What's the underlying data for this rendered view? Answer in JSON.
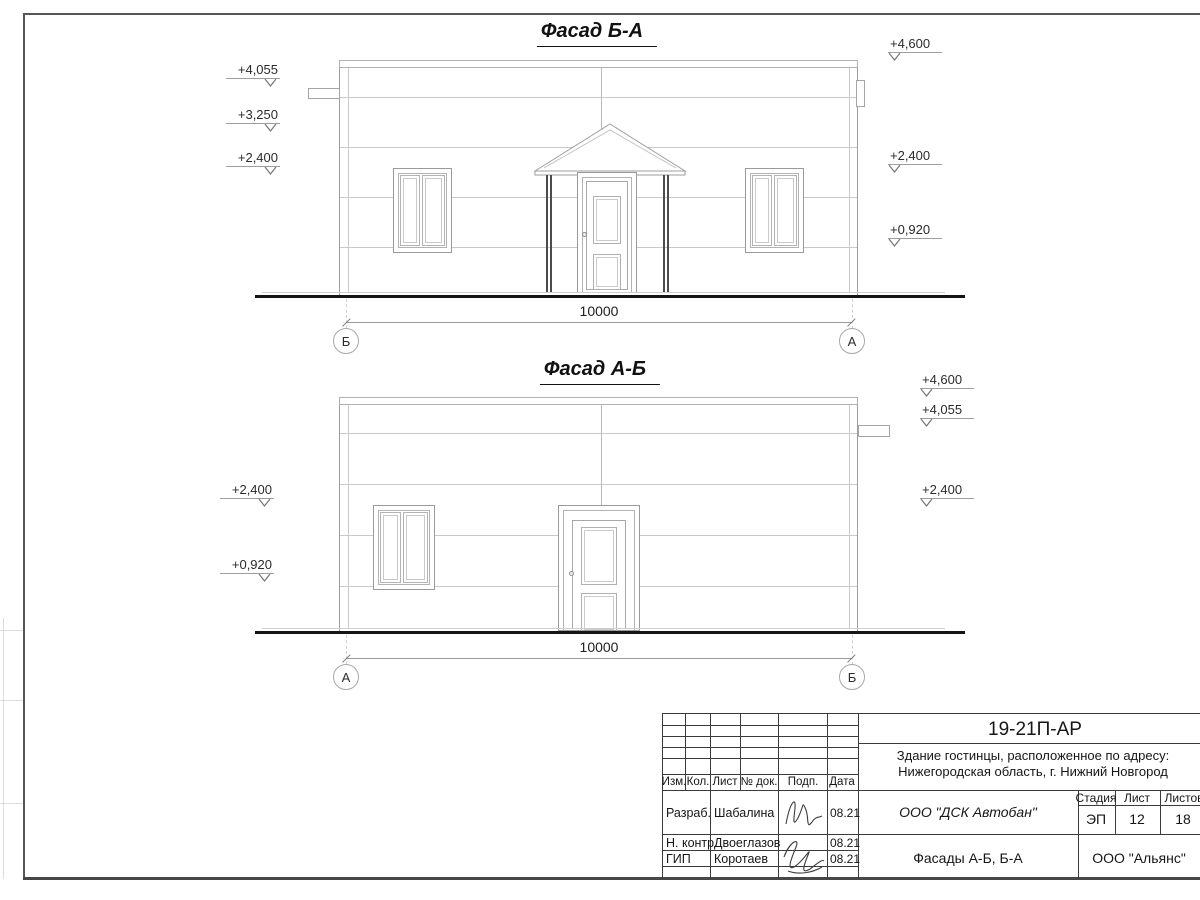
{
  "sheet": {
    "facades": [
      {
        "title": "Фасад Б-А",
        "dimension": "10000",
        "axis_left": "Б",
        "axis_right": "А",
        "levels_left": [
          "+4,055",
          "+3,250",
          "+2,400"
        ],
        "levels_right": [
          "+4,600",
          "+2,400",
          "+0,920"
        ]
      },
      {
        "title": "Фасад А-Б",
        "dimension": "10000",
        "axis_left": "А",
        "axis_right": "Б",
        "levels_left": [
          "+2,400",
          "+0,920"
        ],
        "levels_right": [
          "+4,600",
          "+4,055",
          "+2,400"
        ]
      }
    ],
    "title_block": {
      "code": "19-21П-АР",
      "object_line1": "Здание гостинцы, расположенное по адресу:",
      "object_line2": "Нижегородская область, г. Нижний Новгород",
      "col_izm": "Изм.",
      "col_kol": "Кол.",
      "col_list": "Лист",
      "col_doc": "№ док.",
      "col_podp": "Подп.",
      "col_data": "Дата",
      "row1_role": "Разраб.",
      "row1_name": "Шабалина",
      "row1_date": "08.21",
      "row2_role": "Н. контр.",
      "row2_name": "Двоеглазов",
      "row2_date": "08.21",
      "row3_role": "ГИП",
      "row3_name": "Коротаев",
      "row3_date": "08.21",
      "contractor": "ООО \"ДСК Автобан\"",
      "stage_label": "Стадия",
      "sheet_label": "Лист",
      "sheets_label": "Листов",
      "stage": "ЭП",
      "sheet_no": "12",
      "sheets_total": "18",
      "drawing_title": "Фасады А-Б, Б-А",
      "company": "ООО \"Альянс\""
    }
  }
}
